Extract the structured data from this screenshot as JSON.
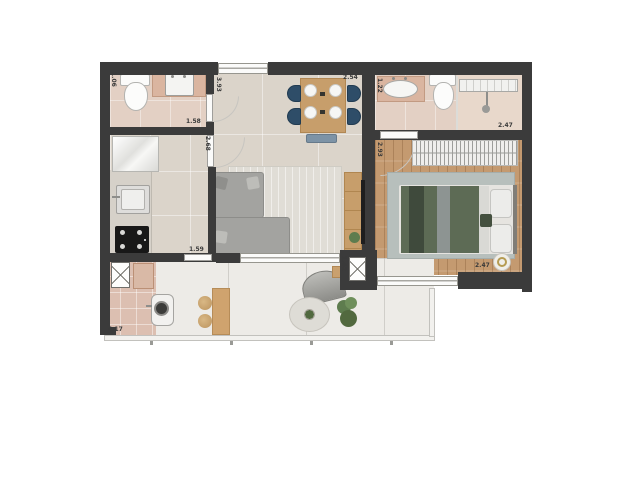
{
  "plan_title": "apartment-floor-plan",
  "measurements": {
    "bath1_width": "1.06",
    "bath1_length": "1.58",
    "hall_height_top": "3.93",
    "hall_height_mid": "2.68",
    "dining_width": "2.54",
    "bath2_width": "1.22",
    "bath2_length": "2.47",
    "bedroom_width": "2.93",
    "bedroom_length": "2.47",
    "kitchen_length": "1.59",
    "balcony_door_width": "1.62",
    "service_length": "4.17"
  },
  "colors": {
    "wall": "#3b3b3b",
    "floor_living": "#dbd4ca",
    "floor_bath": "#e3d0c4",
    "floor_service": "#dcbfb1",
    "floor_bedroom_wood": "#c49a70",
    "floor_balcony": "#edebe7",
    "rug_living": "#e0ddd6",
    "rug_bedroom": "#b7bfbc",
    "sofa": "#a3a3a0",
    "bed_duvet": "#5d6b55",
    "table_wood": "#c79e6b",
    "chair_navy": "#2e4d68"
  }
}
